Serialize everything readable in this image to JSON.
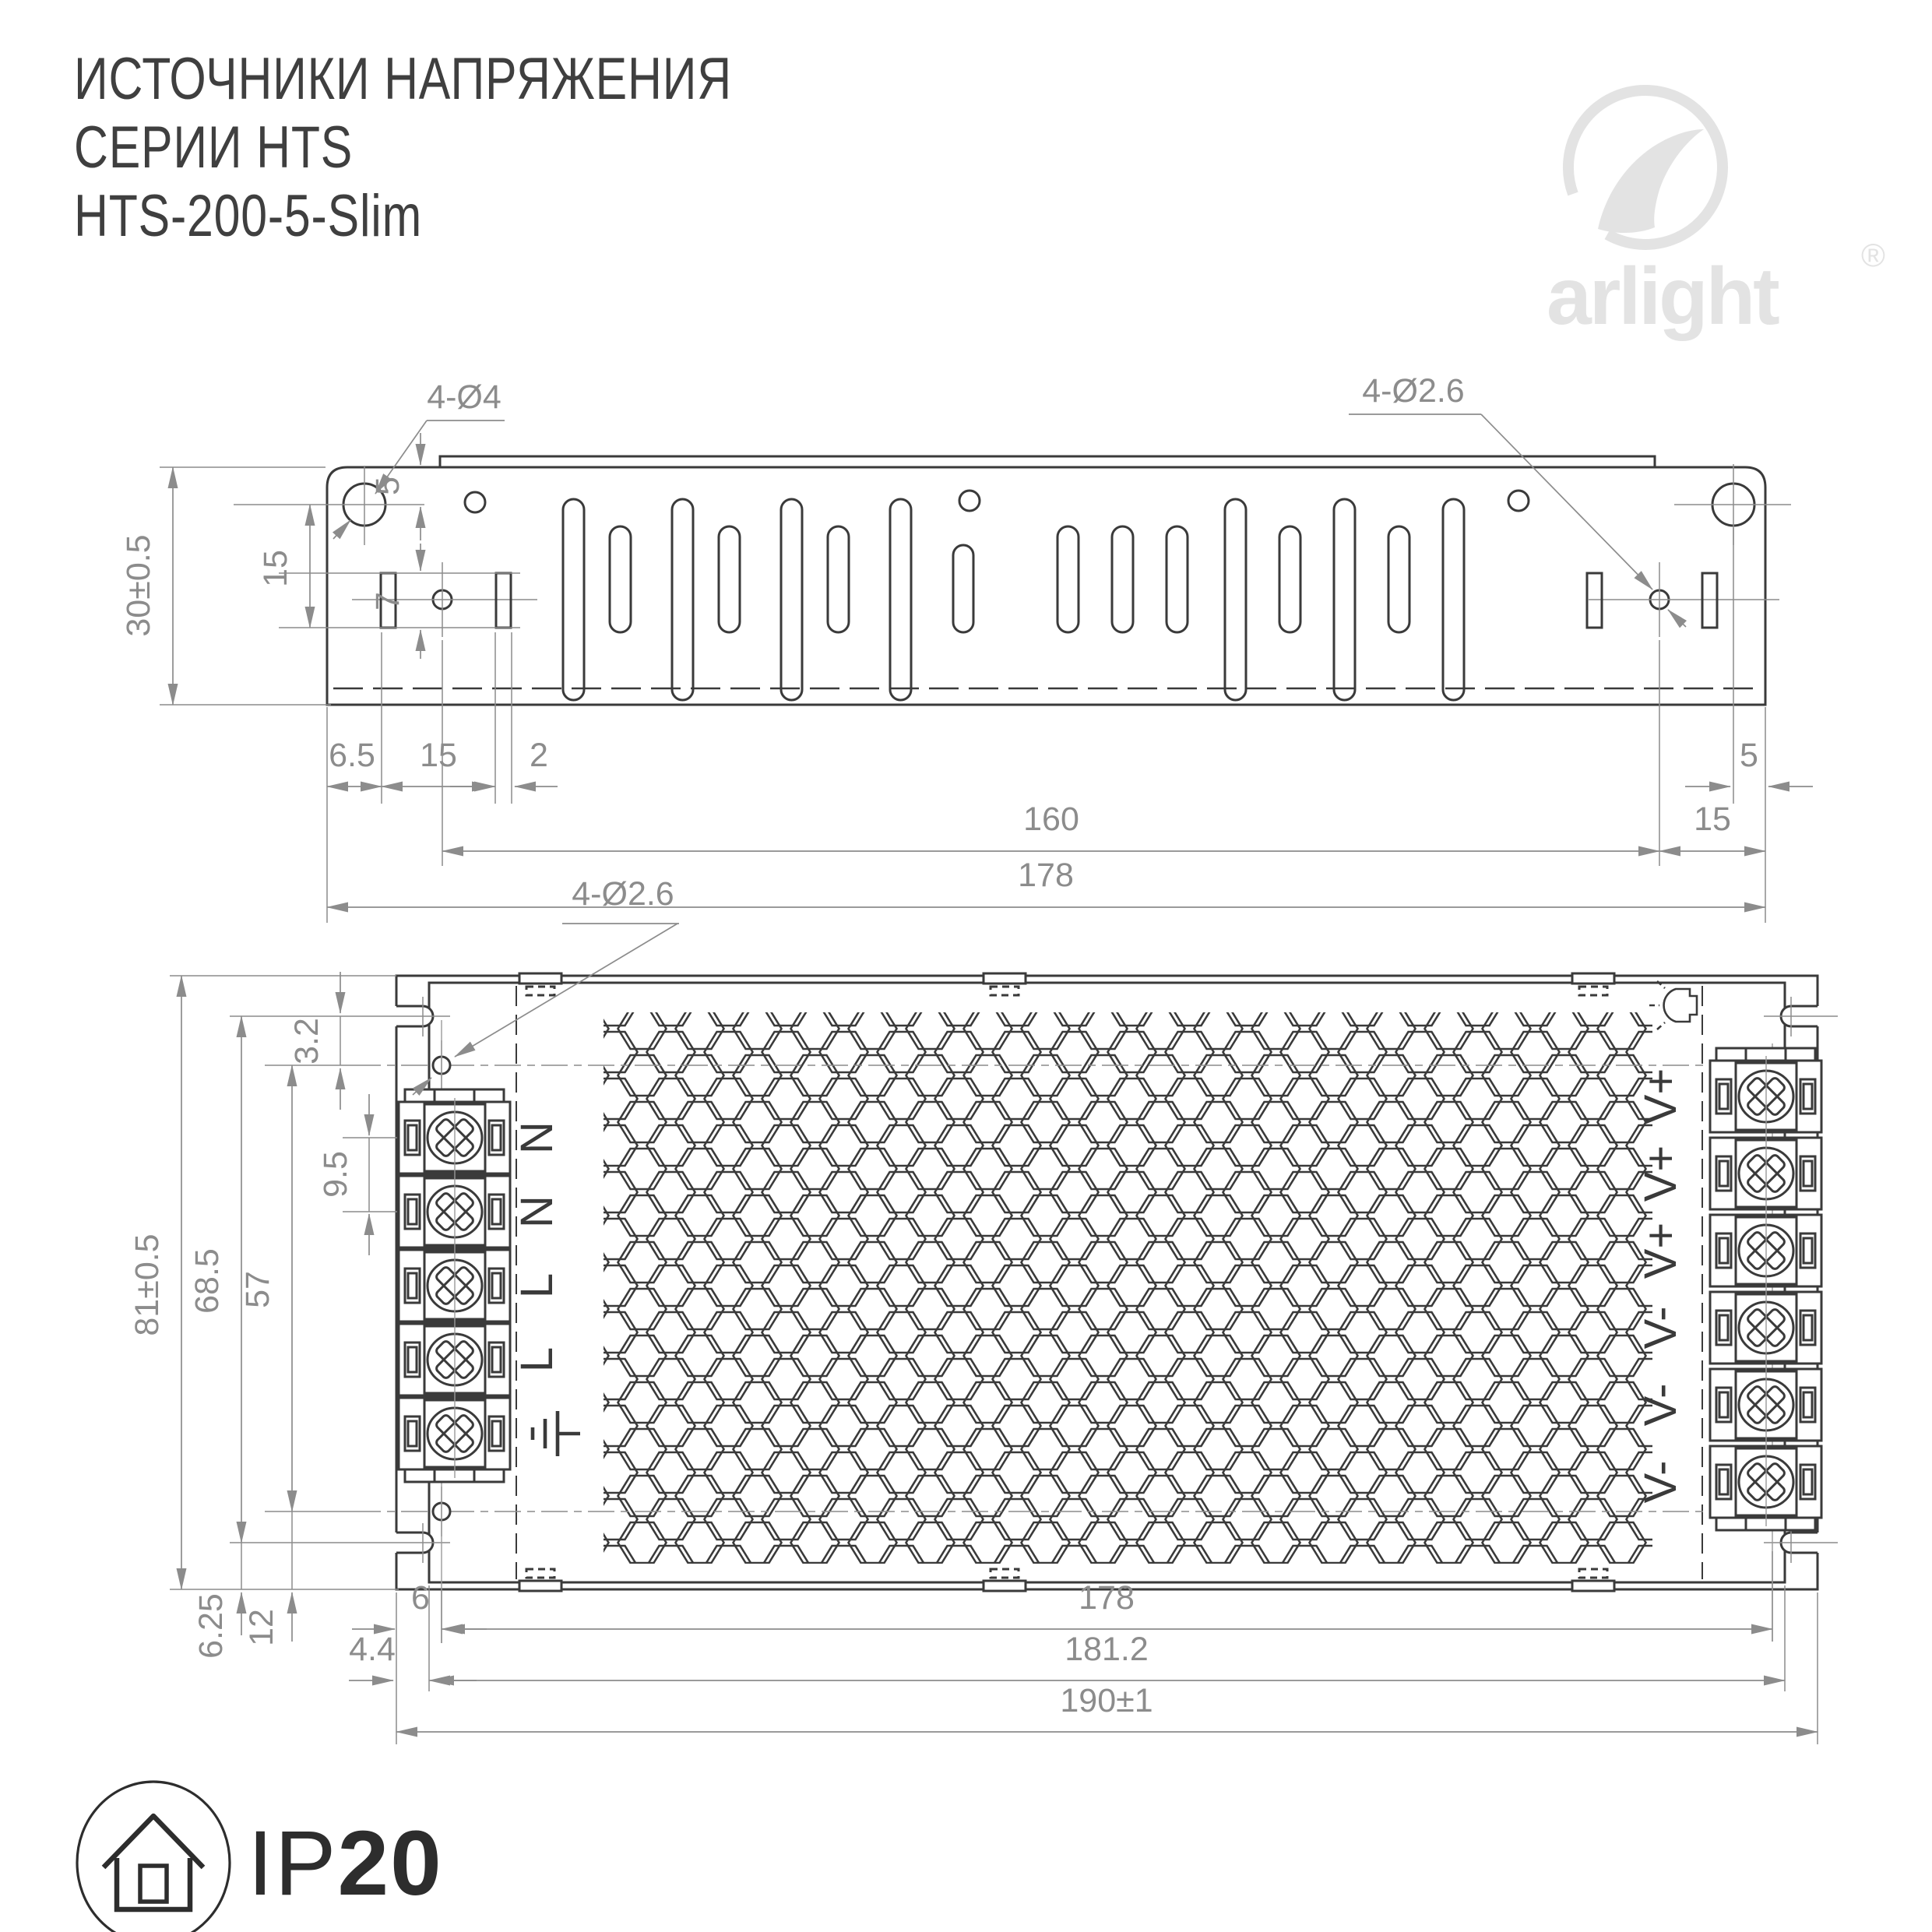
{
  "header": {
    "title_line1": "ИСТОЧНИКИ НАПРЯЖЕНИЯ",
    "title_line2": "СЕРИИ HTS",
    "title_line3": "HTS-200-5-Slim"
  },
  "logo": {
    "brand": "arlight",
    "registered": "®"
  },
  "colors": {
    "line": "#3a3a3a",
    "dimension": "#8c8c8c",
    "logo_gray": "#e3e3e3",
    "title": "#3f3f3f"
  },
  "top_view": {
    "hole_label_left": "4-Ø4",
    "hole_label_right": "4-Ø2.6",
    "dims": {
      "height": "30±0.5",
      "d5_left": "5",
      "d15_left": "15",
      "d7": "7",
      "d65": "6.5",
      "d15_bottom": "15",
      "d2": "2",
      "d160": "160",
      "d15_right": "15",
      "d5_right": "5",
      "d178": "178"
    }
  },
  "front_view": {
    "hole_label": "4-Ø2.6",
    "dims": {
      "height": "81±0.5",
      "d685": "68.5",
      "d57": "57",
      "d32": "3.2",
      "d95": "9.5",
      "d625": "6.25",
      "d12": "12",
      "d6": "6",
      "d44": "4.4",
      "d178": "178",
      "d1812": "181.2",
      "d190": "190±1"
    },
    "input_terminals": [
      "N",
      "N",
      "L",
      "L"
    ],
    "ground_symbol": "earth-ground",
    "output_terminals": [
      "V+",
      "V+",
      "V+",
      "V-",
      "V-",
      "V-"
    ]
  },
  "badge": {
    "ip": "IP",
    "rating": "20"
  }
}
